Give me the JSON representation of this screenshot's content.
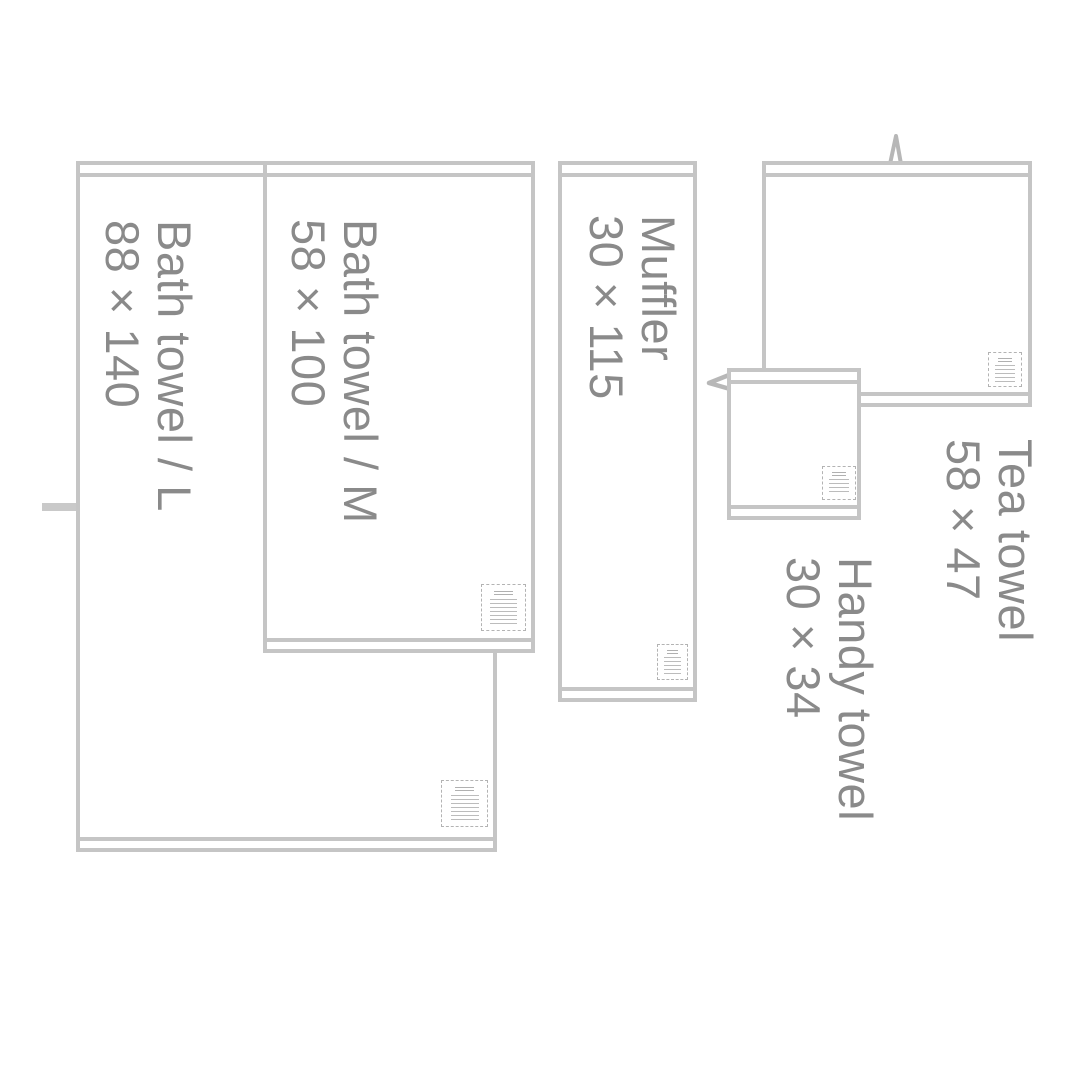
{
  "colors": {
    "outline": "#c5c5c5",
    "label_text": "#8a8a8a",
    "loop": "#b7b7b7"
  },
  "diagram": {
    "items": [
      {
        "id": "bath-towel-l",
        "label": "Bath towel / L",
        "size": "88 × 140"
      },
      {
        "id": "bath-towel-m",
        "label": "Bath towel / M",
        "size": "58 × 100"
      },
      {
        "id": "muffler",
        "label": "Muffler",
        "size": "30 × 115"
      },
      {
        "id": "tea-towel",
        "label": "Tea towel",
        "size": "58 × 47"
      },
      {
        "id": "handy-towel",
        "label": "Handy towel",
        "size": "30 × 34"
      }
    ]
  }
}
